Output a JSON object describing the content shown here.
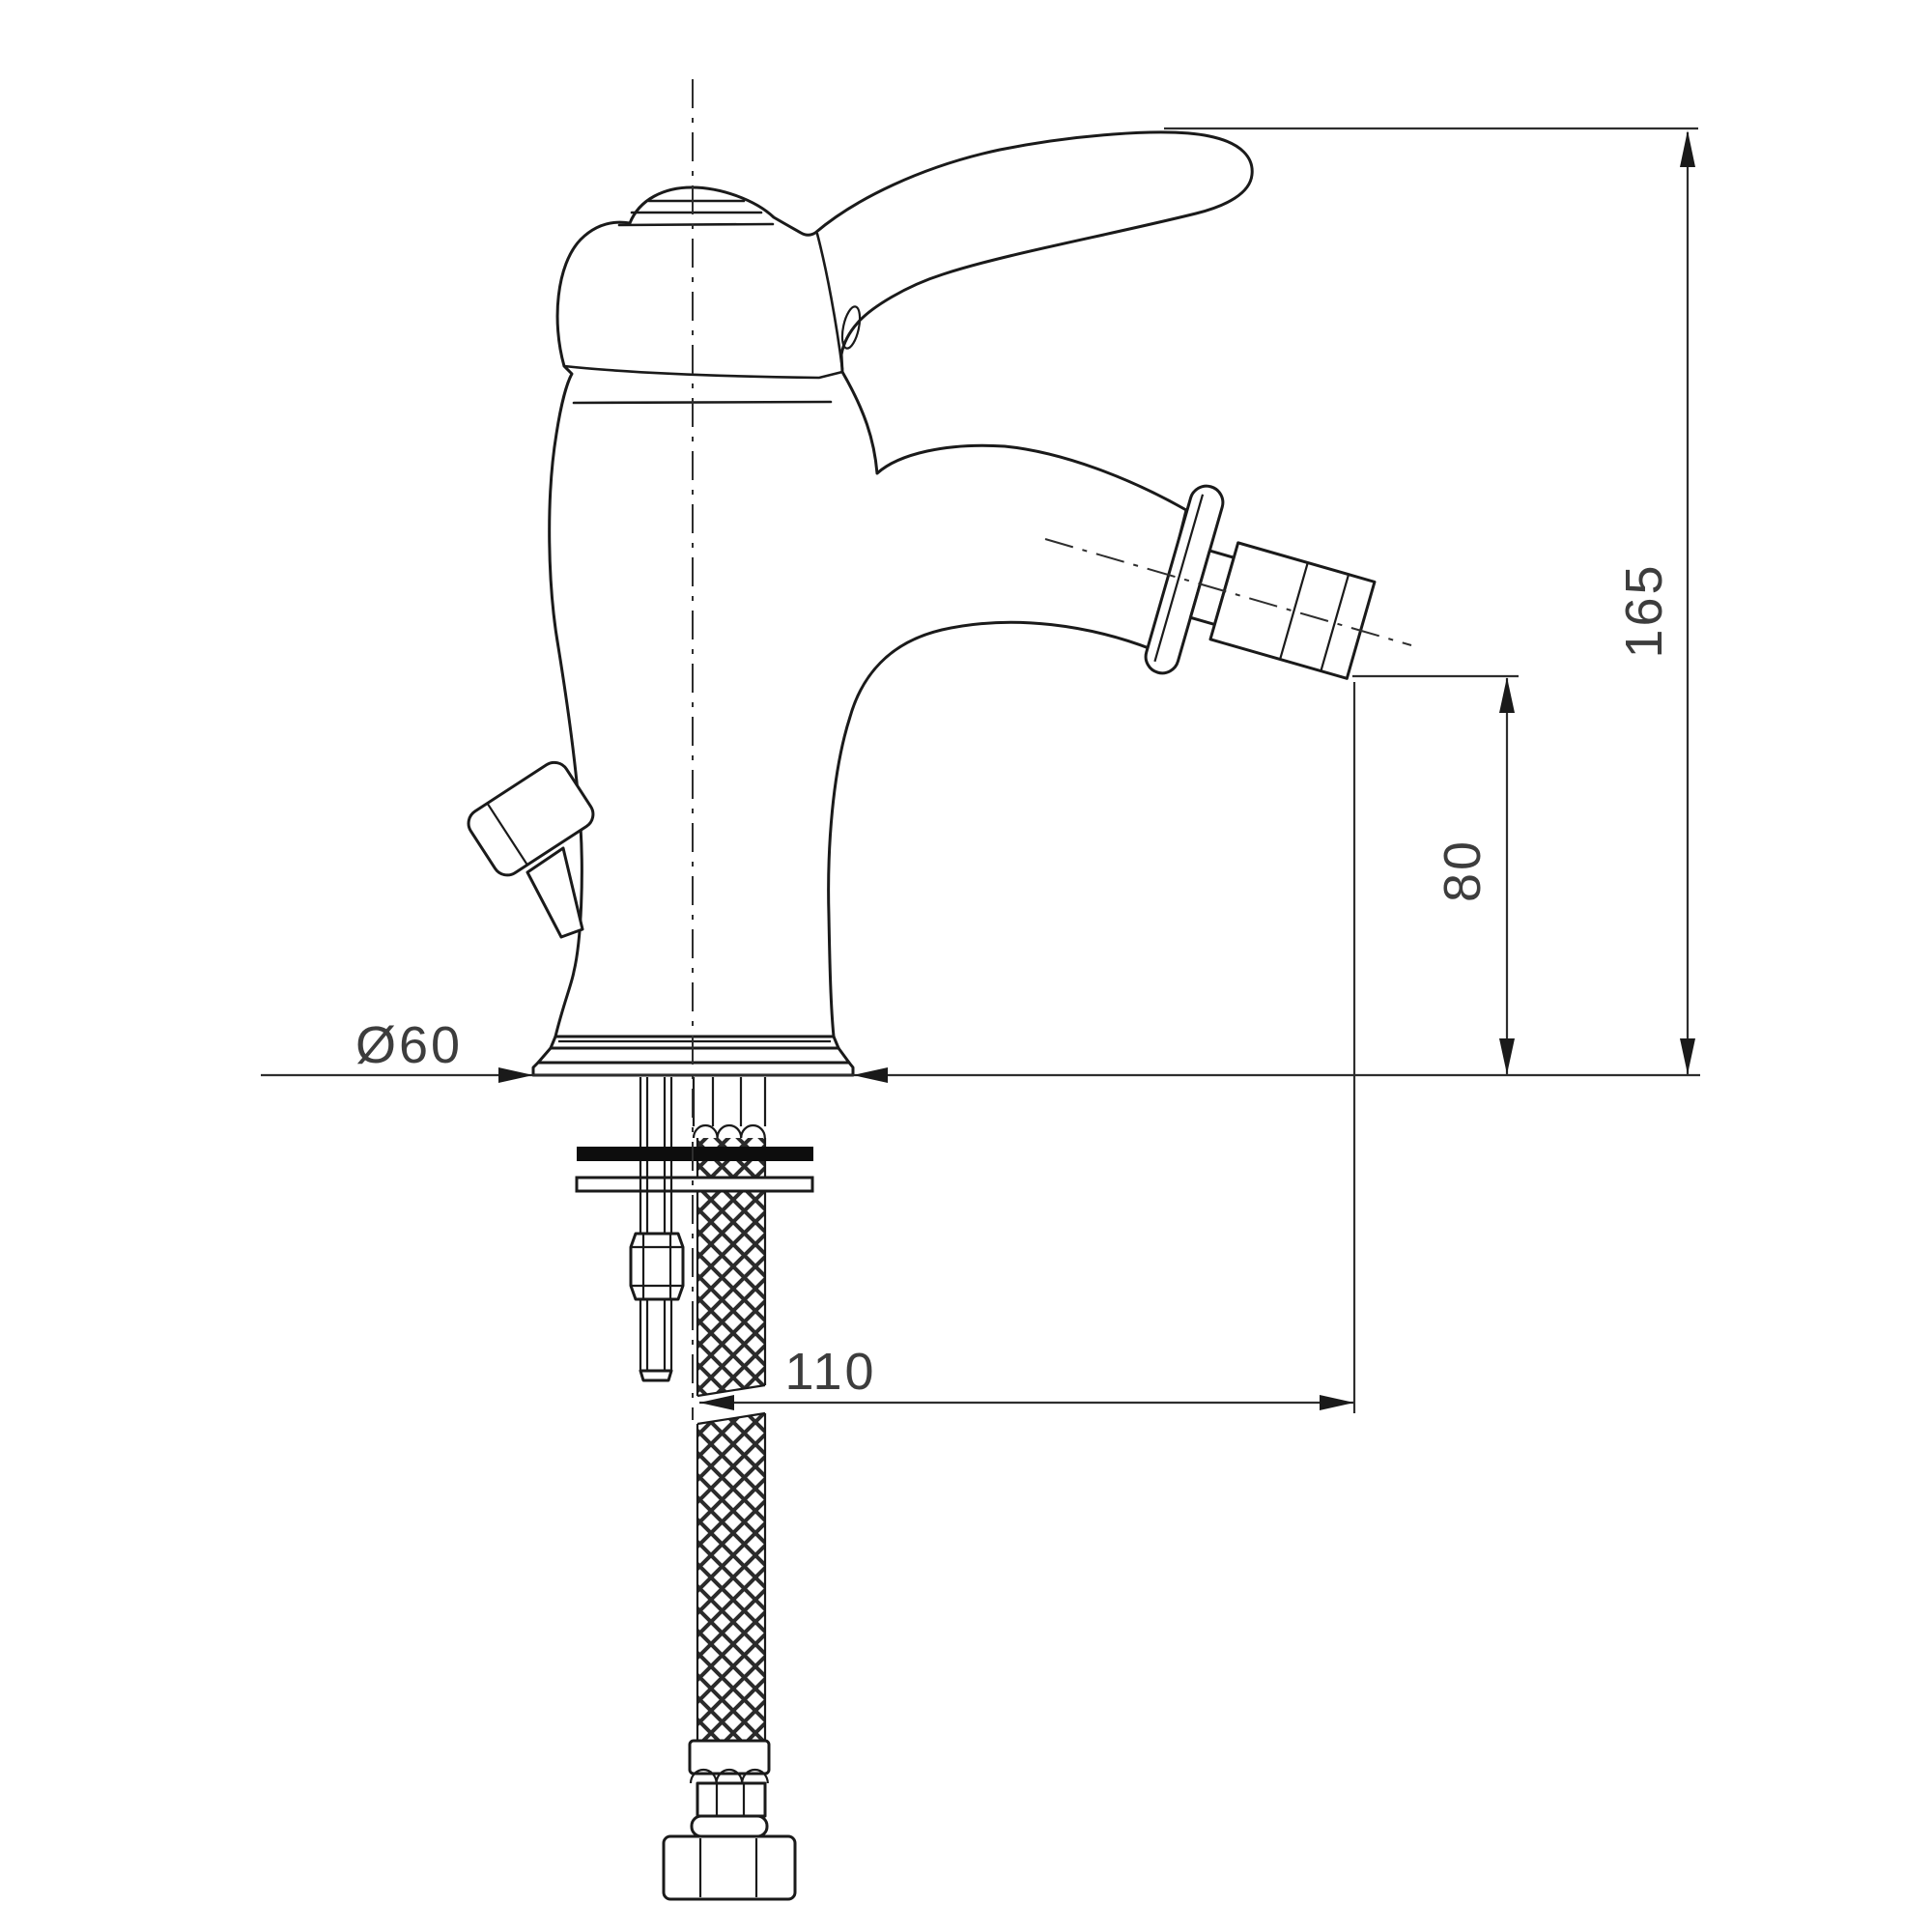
{
  "drawing": {
    "title": "bidet-mixer-technical-drawing",
    "background": "#ffffff",
    "line_color": "#1a1a1a",
    "dim_color": "#3d3d3d",
    "washer_color": "#0d0d0d",
    "labels": {
      "base_diameter": "Ø60",
      "total_height": "165",
      "outlet_height": "80",
      "hose_length": "110"
    }
  }
}
